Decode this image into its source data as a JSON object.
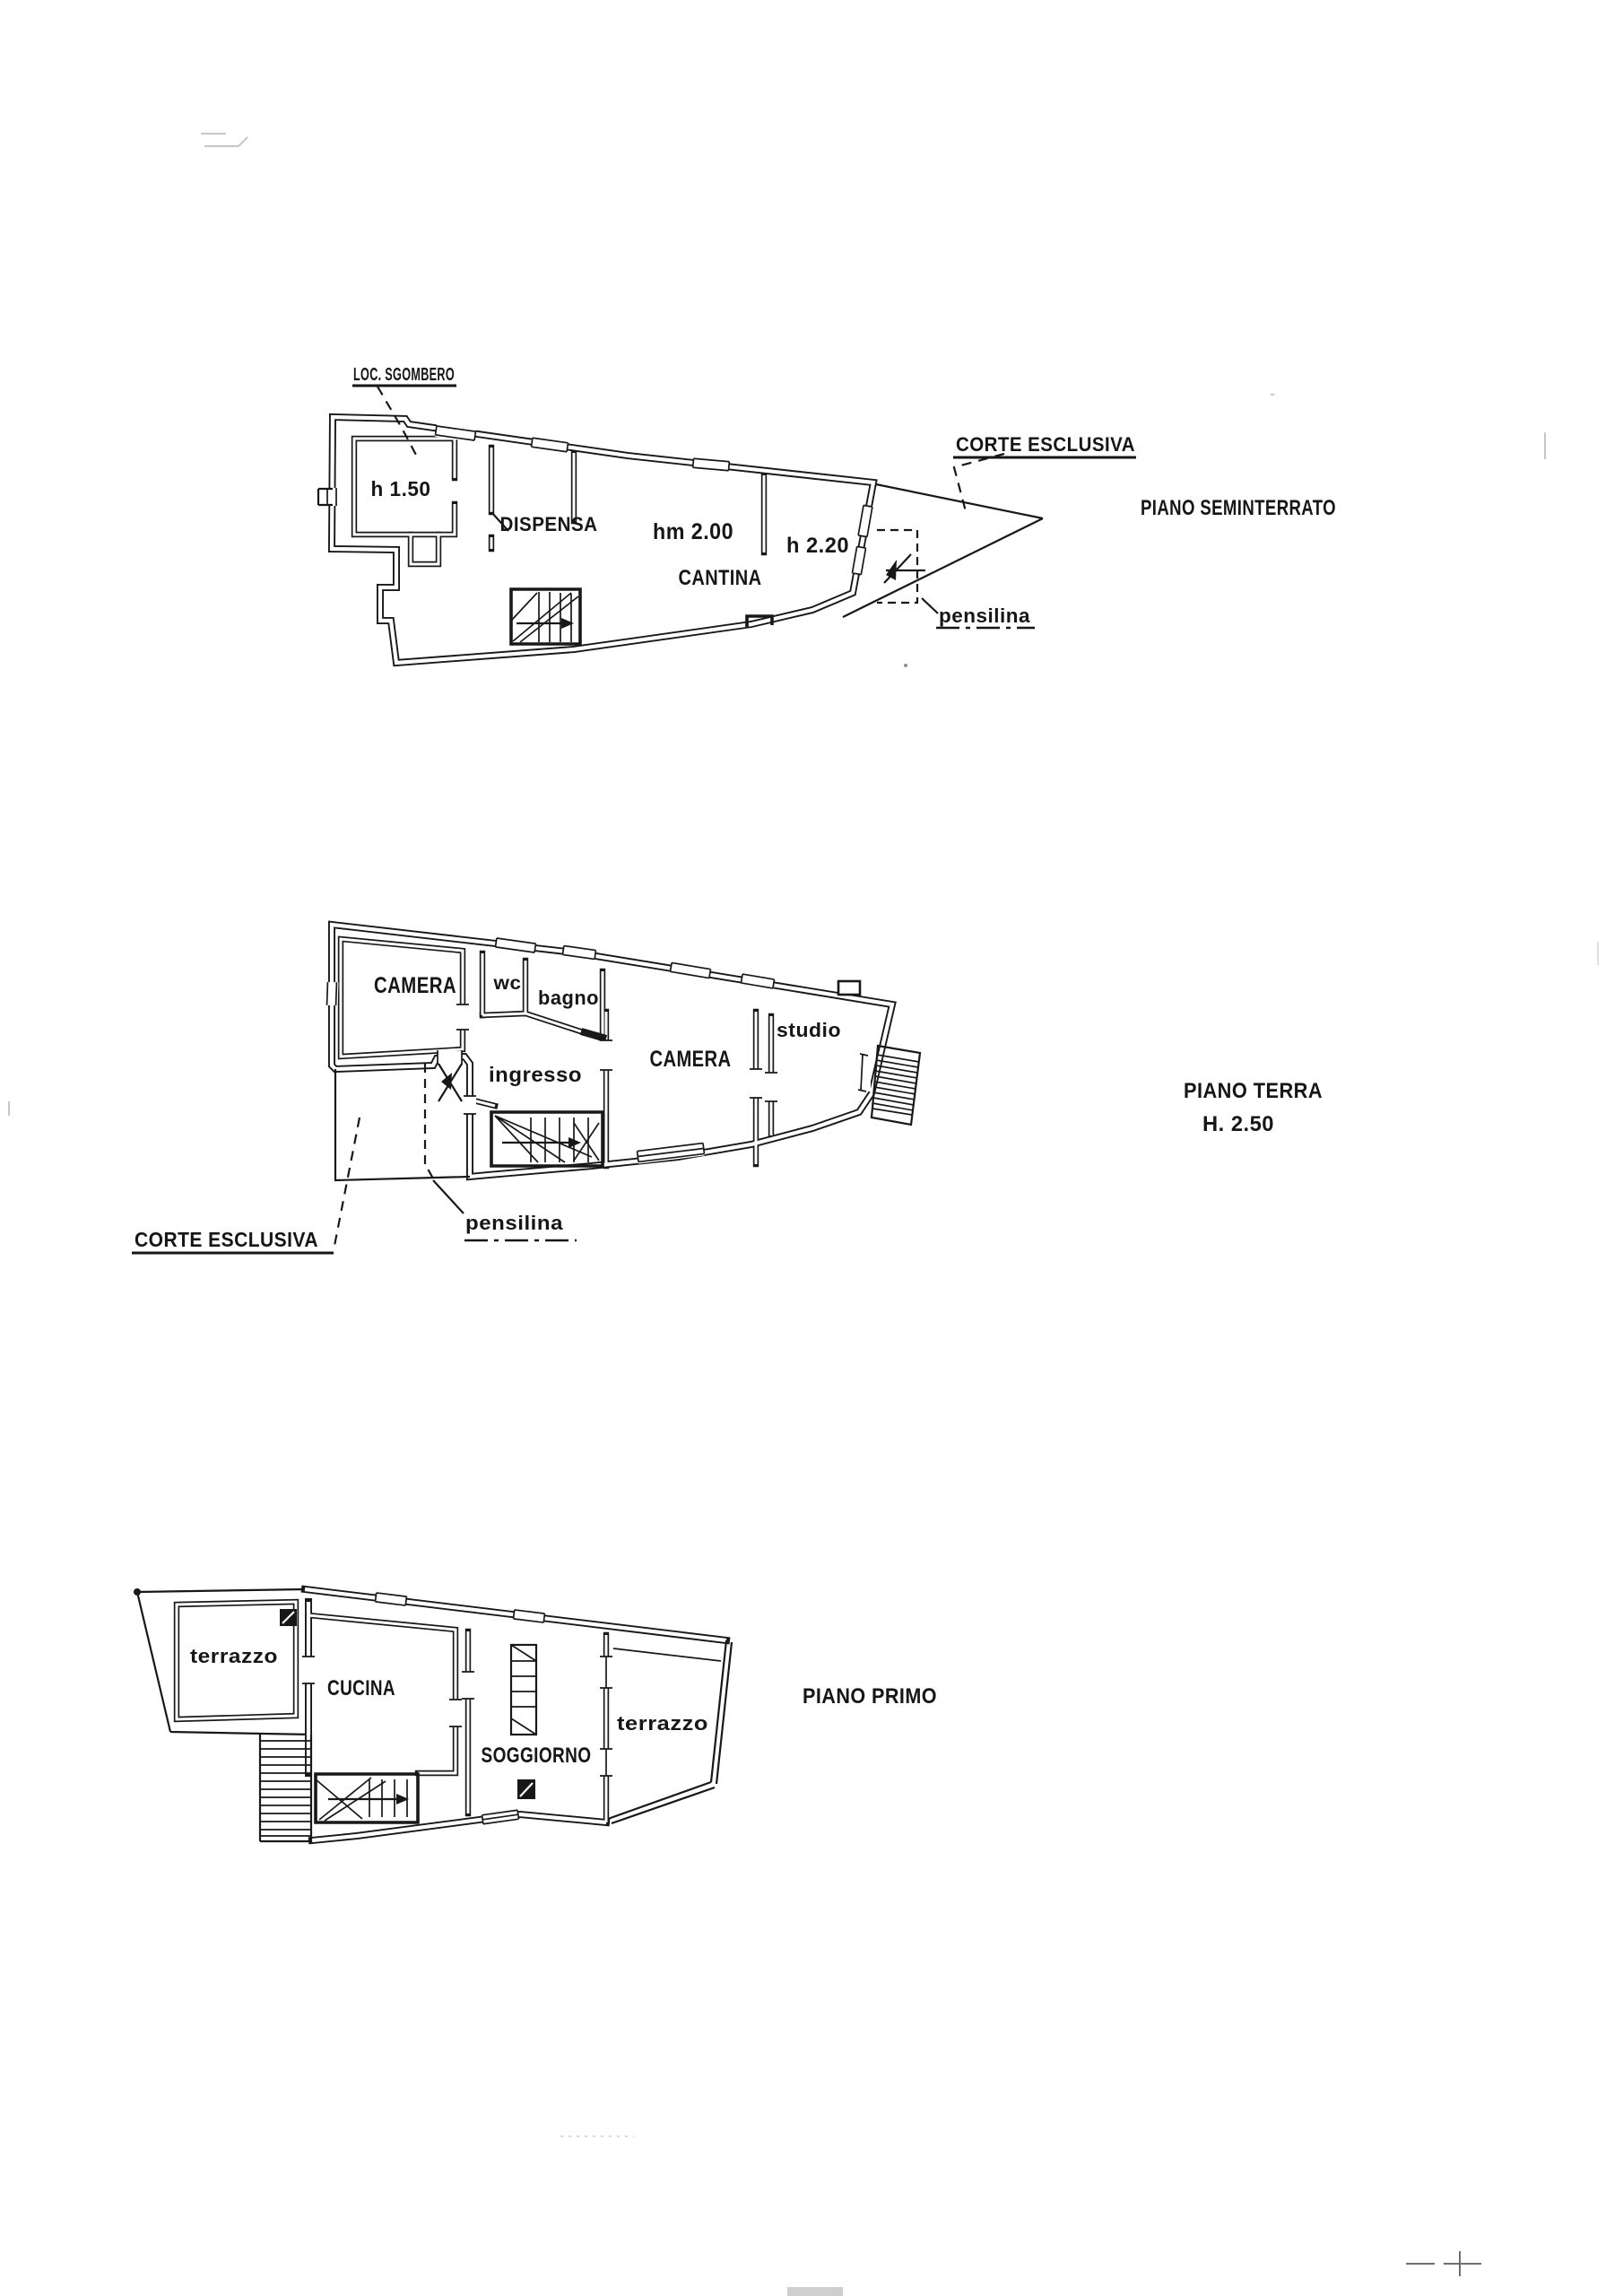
{
  "page": {
    "paper_color": "#ffffff",
    "ink_color": "#181818"
  },
  "plans": {
    "seminterrato": {
      "title": "PIANO SEMINTERRATO",
      "labels": {
        "loc_sgombero": "LOC. SGOMBERO",
        "h_150": "h 1.50",
        "dispensa": "DISPENSA",
        "hm_200": "hm 2.00",
        "cantina": "CANTINA",
        "h_220": "h 2.20",
        "corte_esclusiva": "CORTE ESCLUSIVA",
        "pensilina": "pensilina"
      }
    },
    "terra": {
      "title": "PIANO TERRA",
      "height_note": "H. 2.50",
      "labels": {
        "camera_left": "CAMERA",
        "wc": "wc",
        "bagno": "bagno",
        "ingresso": "ingresso",
        "camera_center": "CAMERA",
        "studio": "studio",
        "corte_esclusiva": "CORTE ESCLUSIVA",
        "pensilina": "pensilina"
      }
    },
    "primo": {
      "title": "PIANO PRIMO",
      "labels": {
        "terrazzo_left": "terrazzo",
        "cucina": "CUCINA",
        "soggiorno": "SOGGIORNO",
        "terrazzo_right": "terrazzo"
      }
    }
  }
}
